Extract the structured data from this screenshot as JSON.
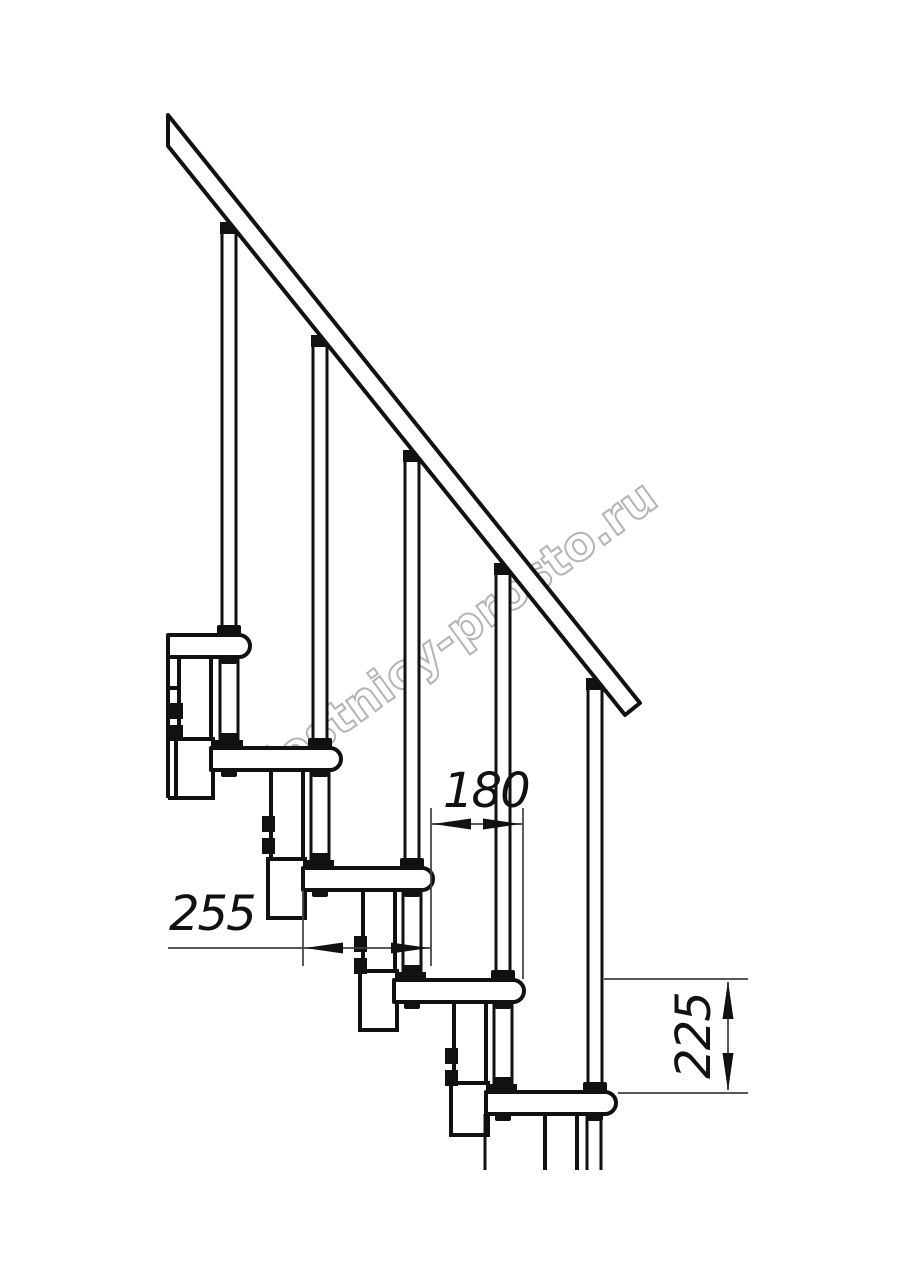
{
  "page": {
    "background": "#ffffff"
  },
  "watermark": {
    "text": "lestnicy-prosto.ru",
    "color": "#b4b4b4"
  },
  "drawing": {
    "kind": "modular staircase side-view technical drawing",
    "steps_visible": 5,
    "balusters_visible": 5,
    "line_color": "#111111",
    "dimension_line_color": "#3f3f3f"
  },
  "dimensions": {
    "tread_depth": {
      "label": "255"
    },
    "going": {
      "label": "180"
    },
    "rise": {
      "label": "225"
    }
  }
}
